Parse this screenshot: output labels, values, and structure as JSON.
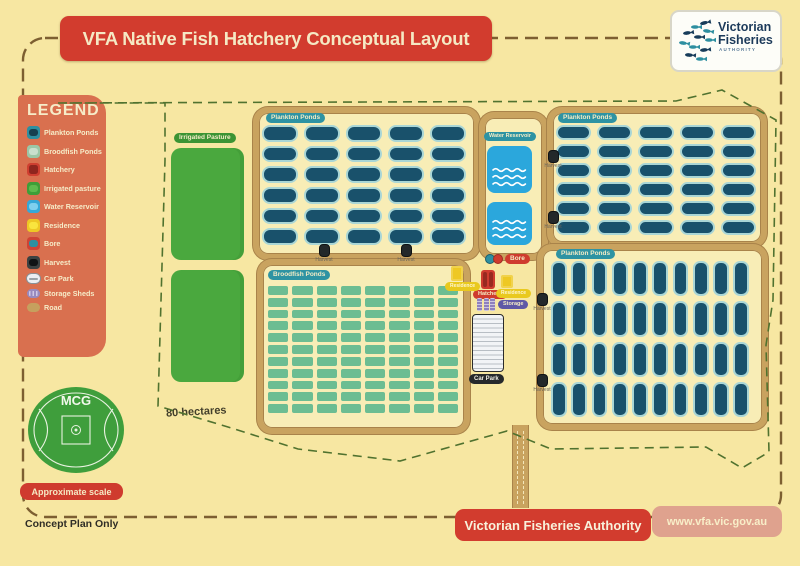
{
  "title": "VFA Native Fish Hatchery Conceptual Layout",
  "logo": {
    "name_line1": "Victorian",
    "name_line2": "Fisheries",
    "name_line3": "AUTHORITY"
  },
  "legend": {
    "title": "LEGEND",
    "items": [
      {
        "key": "plankton",
        "label": "Plankton Ponds"
      },
      {
        "key": "broodfish",
        "label": "Broodfish Ponds"
      },
      {
        "key": "hatchery",
        "label": "Hatchery"
      },
      {
        "key": "pasture",
        "label": "Irrigated pasture"
      },
      {
        "key": "water",
        "label": "Water Reservoir"
      },
      {
        "key": "residence",
        "label": "Residence"
      },
      {
        "key": "bore",
        "label": "Bore"
      },
      {
        "key": "harvest",
        "label": "Harvest"
      },
      {
        "key": "carpark",
        "label": "Car Park"
      },
      {
        "key": "storage",
        "label": "Storage Sheds"
      },
      {
        "key": "road",
        "label": "Road"
      }
    ]
  },
  "map": {
    "labels": {
      "plankton": "Plankton Ponds",
      "broodfish": "Broodfish Ponds",
      "reservoir": "Water Reservoir",
      "pasture": "Irrigated Pasture",
      "residence": "Residence",
      "hatchery": "Hatchery",
      "bore": "Bore",
      "storage": "Storage",
      "carpark": "Car Park",
      "harvest": "Harvest",
      "area": "80 hectares"
    },
    "grids": {
      "plankton_tl": {
        "cols": 5,
        "rows": 6
      },
      "plankton_tr": {
        "cols": 5,
        "rows": 6
      },
      "plankton_br": {
        "cols": 10,
        "rows": 4
      },
      "broodfish": {
        "cols": 8,
        "rows": 11
      }
    },
    "counts": {
      "reservoir_squares": 2,
      "pasture_paddocks": 2,
      "storage_sheds": 3,
      "harvest_points": 6
    }
  },
  "scale": {
    "mcg": "MCG",
    "caption": "Approximate scale"
  },
  "footer": {
    "note": "Concept Plan Only",
    "org": "Victorian Fisheries Authority",
    "url": "www.vfa.vic.gov.au"
  },
  "colors": {
    "background": "#f7e7a2",
    "accent_red": "#d23c2e",
    "road": "#c9a35f",
    "plankton_pond": "#19516b",
    "broodfish_pond": "#6cbd92",
    "pasture": "#4aa83e",
    "water": "#2ba7dc",
    "residence": "#eec824",
    "storage": "#8f80bd",
    "harvest": "#23282a",
    "legend_panel": "#d9704f",
    "boundary": "#50722f"
  }
}
